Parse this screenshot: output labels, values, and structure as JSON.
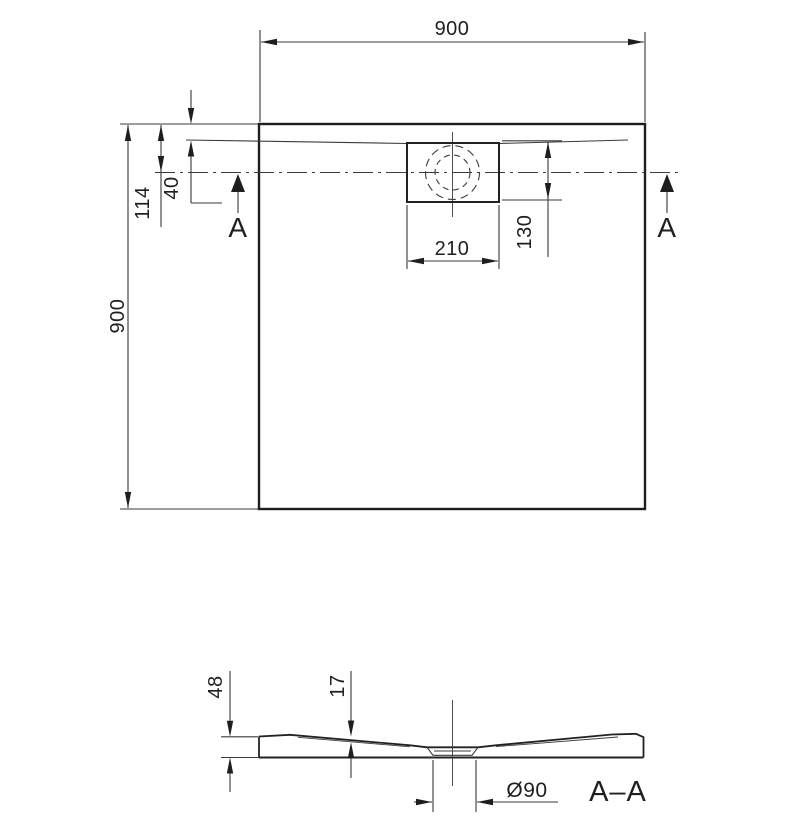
{
  "drawing": {
    "kind": "shower-tray technical drawing",
    "background": "#ffffff",
    "line_color": "#222222"
  },
  "top_view": {
    "width_label": "900",
    "depth_label": "900",
    "rim_offset_label": "40",
    "drain_axis_offset_label": "114",
    "drain_cover_width_label": "210",
    "drain_cover_depth_label": "130",
    "section_marker_left": "A",
    "section_marker_right": "A"
  },
  "section_view": {
    "section_label": "A–A",
    "height_label": "48",
    "depth_label": "17",
    "drain_diameter_label": "Ø90"
  }
}
